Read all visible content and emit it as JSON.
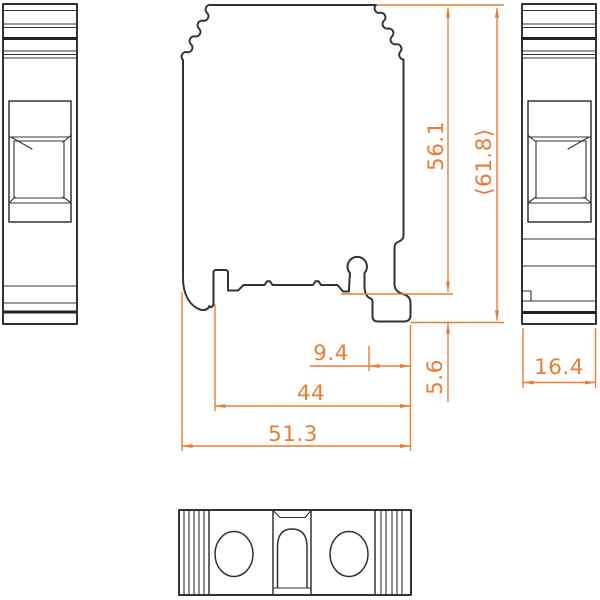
{
  "drawing": {
    "type": "terminal-block-dimension-drawing",
    "views": {
      "left_side": "left-side-view",
      "front": "front-profile-view",
      "right_side": "right-side-view",
      "bottom": "bottom-view"
    },
    "dimensions": {
      "upper_height": "56.1",
      "total_height": "⟨61.8⟩",
      "foot_offset": "9.4",
      "mounting_span": "44",
      "base_width": "51.3",
      "foot_depth": "5.6",
      "block_width": "16.4"
    },
    "colors": {
      "dimension_lines": "#e87d35",
      "object_lines": "#333333",
      "background": "#ffffff"
    }
  }
}
